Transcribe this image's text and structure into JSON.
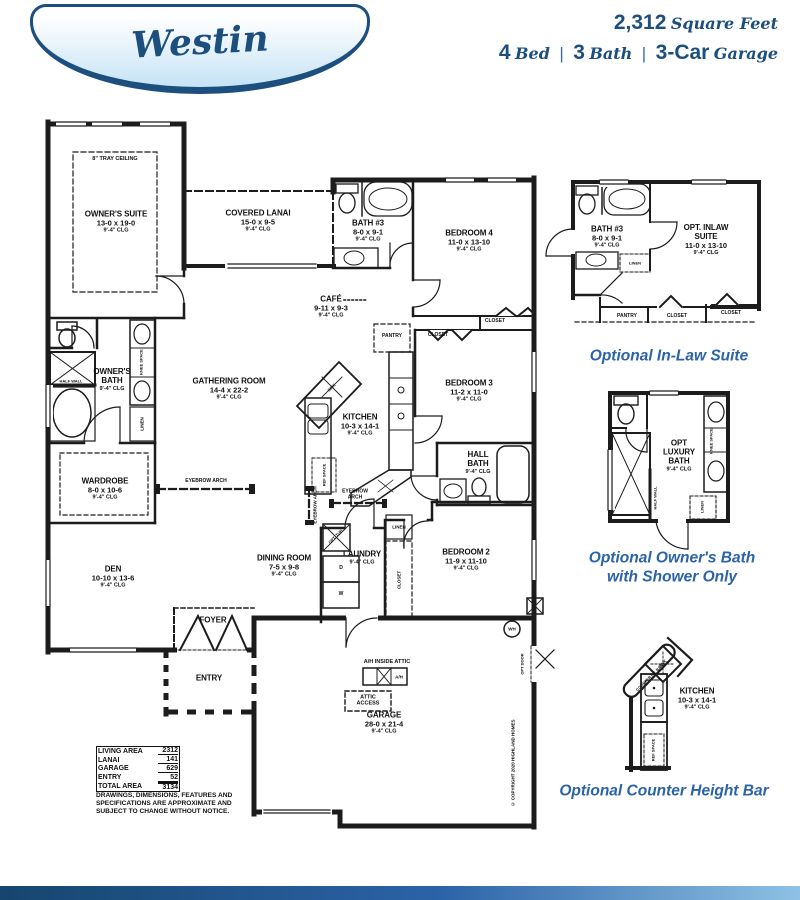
{
  "colors": {
    "navy": "#1c4e7e",
    "caption_blue": "#2b63a8",
    "line": "#1c1c1c",
    "badge_top": "#ffffff",
    "badge_bottom": "#c6e3f5"
  },
  "header": {
    "plan_name": "Westin",
    "sqft": "2,312",
    "sqft_label": "Square Feet",
    "sep": "|",
    "specs": [
      {
        "num": "4",
        "word": "Bed"
      },
      {
        "num": "3",
        "word": "Bath"
      },
      {
        "num": "3-Car",
        "word": "Garage"
      }
    ]
  },
  "rooms": {
    "owners_suite": {
      "name": "OWNER'S SUITE",
      "dims": "13-0 x 19-0",
      "clg": "9'-4\" CLG"
    },
    "covered_lanai": {
      "name": "COVERED LANAI",
      "dims": "15-0 x 9-5",
      "clg": "9'-4\" CLG"
    },
    "bath3": {
      "name": "BATH #3",
      "dims": "8-0 x 9-1",
      "clg": "9'-4\" CLG"
    },
    "bedroom4": {
      "name": "BEDROOM 4",
      "dims": "11-0 x 13-10",
      "clg": "9'-4\" CLG"
    },
    "cafe": {
      "name": "CAFÉ",
      "dims": "9-11 x 9-3",
      "clg": "9'-4\" CLG"
    },
    "owners_bath": {
      "name": "OWNER'S BATH",
      "clg": "9'-4\" CLG"
    },
    "gathering": {
      "name": "GATHERING ROOM",
      "dims": "14-4 x 22-2",
      "clg": "9'-4\" CLG"
    },
    "kitchen": {
      "name": "KITCHEN",
      "dims": "10-3 x 14-1",
      "clg": "9'-4\" CLG"
    },
    "bedroom3": {
      "name": "BEDROOM 3",
      "dims": "11-2 x 11-0",
      "clg": "9'-4\" CLG"
    },
    "wardrobe": {
      "name": "WARDROBE",
      "dims": "8-0 x 10-6",
      "clg": "9'-4\" CLG"
    },
    "hall_bath": {
      "name": "HALL BATH",
      "clg": "9'-4\" CLG"
    },
    "den": {
      "name": "DEN",
      "dims": "10-10 x 13-6",
      "clg": "9'-4\" CLG"
    },
    "dining": {
      "name": "DINING ROOM",
      "dims": "7-5 x 9-8",
      "clg": "9'-4\" CLG"
    },
    "laundry": {
      "name": "LAUNDRY",
      "clg": "9'-4\" CLG"
    },
    "bedroom2": {
      "name": "BEDROOM 2",
      "dims": "11-9 x 11-10",
      "clg": "9'-4\" CLG"
    },
    "foyer": {
      "name": "FOYER"
    },
    "entry": {
      "name": "ENTRY"
    },
    "garage": {
      "name": "GARAGE",
      "dims": "28-0 x 21-4",
      "clg": "9'-4\" CLG"
    }
  },
  "labels": {
    "tray": "8\" TRAY CEILING",
    "pantry": "PANTRY",
    "closet": "CLOSET",
    "linen": "LINEN",
    "knee_space": "KNEE SPACE",
    "half_wall": "HALF WALL",
    "ref_space": "REF SPACE",
    "opt_tub": "OPT. TUB",
    "sink": "SINK",
    "eyebrow_arch": "EYEBROW ARCH",
    "wh": "WH",
    "opt_door": "OPT DOOR",
    "ah_inside_attic": "A/H INSIDE ATTIC",
    "ah": "A/H",
    "attic_access": "ATTIC ACCESS",
    "washer": "W",
    "dryer": "D",
    "copyright": "© COPYRIGHT 2020 HIGHLAND HOMES"
  },
  "area_table": {
    "rows": [
      {
        "label": "LIVING AREA",
        "value": "2312"
      },
      {
        "label": "LANAI",
        "value": "141"
      },
      {
        "label": "GARAGE",
        "value": "629"
      },
      {
        "label": "ENTRY",
        "value": "52"
      },
      {
        "label": "TOTAL AREA",
        "value": "3134"
      }
    ]
  },
  "disclaimer": "DRAWINGS, DIMENSIONS, FEATURES AND SPECIFICATIONS ARE APPROXIMATE AND SUBJECT TO CHANGE WITHOUT NOTICE.",
  "options": {
    "inlaw": {
      "caption": "Optional In-Law Suite",
      "bath": {
        "name": "BATH #3",
        "dims": "8-0 x 9-1",
        "clg": "9'-4\" CLG"
      },
      "suite": {
        "name": "OPT. INLAW SUITE",
        "dims": "11-0 x 13-10",
        "clg": "9'-4\" CLG"
      }
    },
    "owners_bath": {
      "caption_line1": "Optional Owner's Bath",
      "caption_line2": "with Shower Only",
      "room": {
        "name": "OPT LUXURY BATH",
        "clg": "9'-4\" CLG"
      }
    },
    "counter_bar": {
      "caption": "Optional Counter Height Bar",
      "room": {
        "name": "KITCHEN",
        "dims": "10-3 x 14-1",
        "clg": "9'-4\" CLG"
      },
      "bar_label": "COUNTER HT. BAR"
    }
  }
}
